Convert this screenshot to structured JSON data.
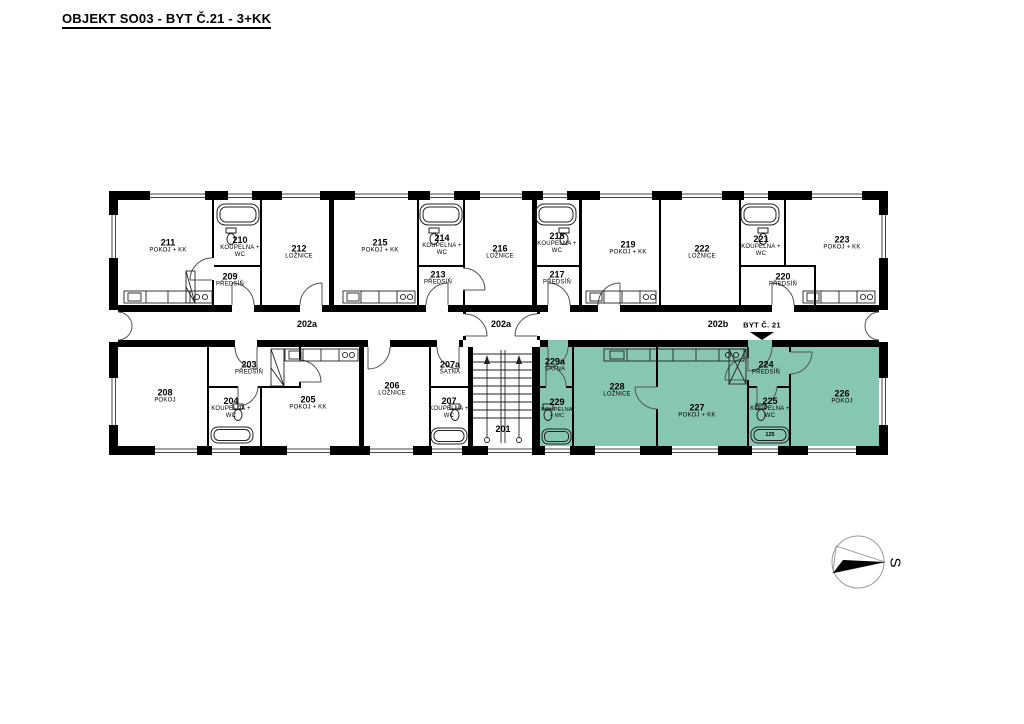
{
  "title": "OBJEKT SO03 - BYT Č.21 - 3+KK",
  "colors": {
    "highlight": "#87C6B3",
    "wall": "#000000"
  },
  "highlighted_apartment": {
    "label": "BYT Č. 21",
    "rooms": [
      "224",
      "225",
      "226",
      "227",
      "228",
      "229",
      "229a"
    ]
  },
  "corridor": {
    "left_label": "202a",
    "vestibule_label": "202a",
    "right_label": "202b",
    "apartment_note": "BYT Č. 21"
  },
  "compass": {
    "label": "S"
  },
  "fixtures": {
    "tub_label_225": "125"
  },
  "rooms": {
    "r201": {
      "number": "201",
      "name": ""
    },
    "r203": {
      "number": "203",
      "name": "PŘEDSÍŇ"
    },
    "r204": {
      "number": "204",
      "name": "KOUPELNA + WC"
    },
    "r205": {
      "number": "205",
      "name": "POKOJ + KK"
    },
    "r206": {
      "number": "206",
      "name": "LOŽNICE"
    },
    "r207a": {
      "number": "207a",
      "name": "ŠATNA"
    },
    "r207": {
      "number": "207",
      "name": "KOUPELNA + WC"
    },
    "r208": {
      "number": "208",
      "name": "POKOJ"
    },
    "r209": {
      "number": "209",
      "name": "PŘEDSÍŇ"
    },
    "r210": {
      "number": "210",
      "name": "KOUPELNA + WC"
    },
    "r211": {
      "number": "211",
      "name": "POKOJ + KK"
    },
    "r212": {
      "number": "212",
      "name": "LOŽNICE"
    },
    "r213": {
      "number": "213",
      "name": "PŘEDSÍŇ"
    },
    "r214": {
      "number": "214",
      "name": "KOUPELNA + WC"
    },
    "r215": {
      "number": "215",
      "name": "POKOJ + KK"
    },
    "r216": {
      "number": "216",
      "name": "LOŽNICE"
    },
    "r217": {
      "number": "217",
      "name": "PŘEDSÍŇ"
    },
    "r218": {
      "number": "218",
      "name": "KOUPELNA + WC"
    },
    "r219": {
      "number": "219",
      "name": "POKOJ + KK"
    },
    "r220": {
      "number": "220",
      "name": "PŘEDSÍŇ"
    },
    "r221": {
      "number": "221",
      "name": "KOUPELNA + WC"
    },
    "r222": {
      "number": "222",
      "name": "LOŽNICE"
    },
    "r223": {
      "number": "223",
      "name": "POKOJ + KK"
    },
    "r224": {
      "number": "224",
      "name": "PŘEDSÍŇ"
    },
    "r225": {
      "number": "225",
      "name": "KOUPELNA + WC"
    },
    "r226": {
      "number": "226",
      "name": "POKOJ"
    },
    "r227": {
      "number": "227",
      "name": "POKOJ + KK"
    },
    "r228": {
      "number": "228",
      "name": "LOŽNICE"
    },
    "r229": {
      "number": "229",
      "name": "KOUPELNA + WC"
    },
    "r229a": {
      "number": "229a",
      "name": "ŠATNA"
    }
  }
}
